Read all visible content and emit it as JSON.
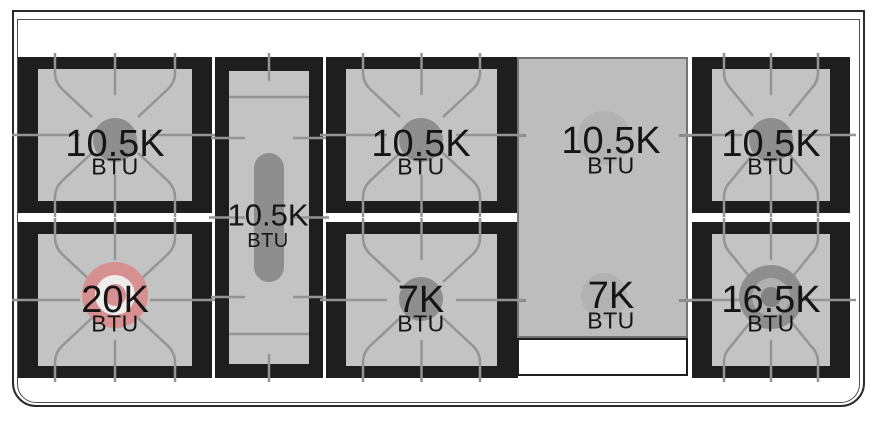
{
  "diagram": {
    "kind": "range-cooktop-burner-layout",
    "unit_label": "BTU"
  },
  "burners": [
    {
      "id": "left-rear",
      "rating": "10.5K",
      "unit": "BTU",
      "style": "standard-gray"
    },
    {
      "id": "center-oval",
      "rating": "10.5K",
      "unit": "BTU",
      "style": "oval-gray"
    },
    {
      "id": "middle-rear",
      "rating": "10.5K",
      "unit": "BTU",
      "style": "standard-gray"
    },
    {
      "id": "griddle-rear",
      "rating": "10.5K",
      "unit": "BTU",
      "style": "under-griddle"
    },
    {
      "id": "right-rear",
      "rating": "10.5K",
      "unit": "BTU",
      "style": "standard-gray"
    },
    {
      "id": "left-front",
      "rating": "20K",
      "unit": "BTU",
      "style": "dual-ring-pink"
    },
    {
      "id": "middle-front",
      "rating": "7K",
      "unit": "BTU",
      "style": "standard-gray"
    },
    {
      "id": "griddle-front",
      "rating": "7K",
      "unit": "BTU",
      "style": "under-griddle"
    },
    {
      "id": "right-front",
      "rating": "16.5K",
      "unit": "BTU",
      "style": "dual-ring-gray"
    }
  ],
  "colors": {
    "accent_burner_pink": "#d69090",
    "burner_gray": "#8e8e8e",
    "grate_black": "#1e1e1e",
    "grate_surface_gray": "#c3c3c3",
    "griddle_gray": "#bdbdbd",
    "pattern_line_gray": "#949494",
    "frame_line": "#2b2b2b"
  }
}
